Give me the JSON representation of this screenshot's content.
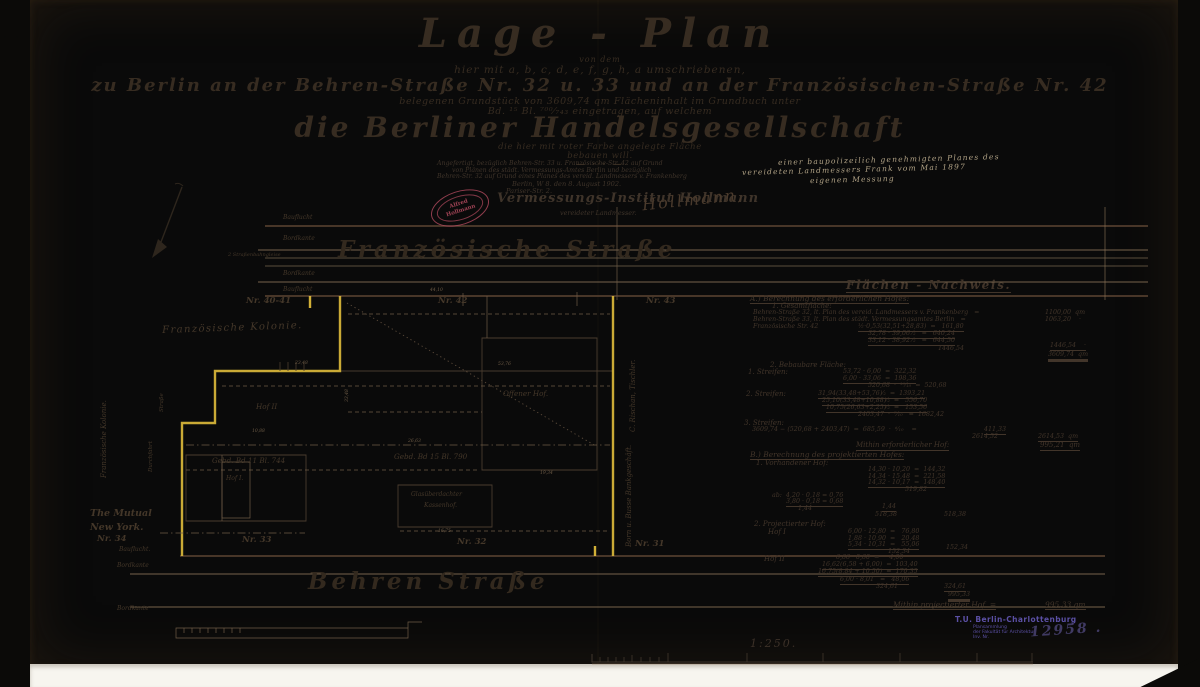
{
  "header": {
    "title": "Lage - Plan",
    "l1": "von dem",
    "l2": "hier mit a, b, c, d, e, f, g, h, a umschriebenen,",
    "l3": "zu Berlin an der Behren-Straße Nr. 32 u. 33 und an der Französischen-Straße Nr. 42",
    "l4": "belegenen Grundstück von 3609,74 qm Flächeninhalt im Grundbuch unter",
    "l5": "Bd. ¹⁵ Bl. ⁷⁰⁰⁄₇₄₃ eingetragen, auf welchem",
    "company": "die Berliner Handelsgesellschaft",
    "l6": "die hier mit roter Farbe angelegte Fläche",
    "l7": "bebauen will.",
    "divider": "— ··· —"
  },
  "attestation": {
    "a1": "Angefertigt, bezüglich Behren-Str. 33 u. Französische-Str. 42 auf Grund",
    "a2": "von Plänen des städt. Vermessungs-Amtes Berlin und bezüglich",
    "a3": "Behren-Str. 32 auf Grund eines Planes des vereid. Landmessers v. Frankenberg",
    "a4": "Berlin, W 8. den 8. August 1902.",
    "a5": "Pariser-Str. 2.",
    "institute": "Vermessungs-Institut Hollmann",
    "signature": "Hollmann,",
    "signer_title": "vereideter Landmesser.",
    "red_stamp": {
      "line1": "Alfred",
      "line2": "Hollmann"
    }
  },
  "pencil": {
    "lines": [
      {
        "t": "einer baupolizeilich genehmigten Planes des",
        "x": 778,
        "y": 156
      },
      {
        "t": "vereideten Landmessers Frank vom Mai 1897",
        "x": 742,
        "y": 166
      },
      {
        "t": "eigenen Messung",
        "x": 810,
        "y": 176
      }
    ]
  },
  "plan": {
    "labels": [
      {
        "t": "Bauflucht",
        "x": 283,
        "y": 215,
        "c": "s6"
      },
      {
        "t": "Bordkante",
        "x": 283,
        "y": 236,
        "c": "s6"
      },
      {
        "t": "2 Straßenbahngleise",
        "x": 228,
        "y": 253,
        "c": "s5"
      },
      {
        "t": "Französische Straße",
        "x": 338,
        "y": 238,
        "c": "street"
      },
      {
        "t": "Bordkante",
        "x": 283,
        "y": 271,
        "c": "s6"
      },
      {
        "t": "Bauflucht",
        "x": 283,
        "y": 287,
        "c": "s6"
      },
      {
        "t": "44,10",
        "x": 430,
        "y": 289,
        "c": "dim"
      },
      {
        "t": "Nr. 40-41",
        "x": 246,
        "y": 297,
        "c": "s8"
      },
      {
        "t": "Nr. 42",
        "x": 438,
        "y": 297,
        "c": "s8"
      },
      {
        "t": "Nr. 43",
        "x": 646,
        "y": 297,
        "c": "s8"
      },
      {
        "t": "Französische Kolonie.",
        "x": 162,
        "y": 326,
        "c": "kol"
      },
      {
        "t": "Hof II",
        "x": 256,
        "y": 403,
        "c": "s7"
      },
      {
        "t": "Offener Hof.",
        "x": 503,
        "y": 390,
        "c": "s7"
      },
      {
        "t": "Gebd. Bd 11 Bl. 744",
        "x": 212,
        "y": 457,
        "c": "s7"
      },
      {
        "t": "Gebd. Bd 15 Bl. 790",
        "x": 394,
        "y": 453,
        "c": "s7"
      },
      {
        "t": "Hof I.",
        "x": 226,
        "y": 476,
        "c": "s6"
      },
      {
        "t": "Glasüberdachter",
        "x": 411,
        "y": 492,
        "c": "s6"
      },
      {
        "t": "Kassenhof.",
        "x": 424,
        "y": 503,
        "c": "s6"
      },
      {
        "t": "The Mutual",
        "x": 90,
        "y": 509,
        "c": "s9i"
      },
      {
        "t": "New York.",
        "x": 90,
        "y": 523,
        "c": "s9i"
      },
      {
        "t": "Nr. 34",
        "x": 97,
        "y": 535,
        "c": "s8"
      },
      {
        "t": "Bauflucht.",
        "x": 119,
        "y": 547,
        "c": "s6"
      },
      {
        "t": "Nr. 33",
        "x": 242,
        "y": 536,
        "c": "s8"
      },
      {
        "t": "Nr. 32",
        "x": 457,
        "y": 538,
        "c": "s8"
      },
      {
        "t": "Nr. 31",
        "x": 635,
        "y": 540,
        "c": "s8"
      },
      {
        "t": "Bordkante",
        "x": 117,
        "y": 563,
        "c": "s6"
      },
      {
        "t": "Behren Straße",
        "x": 308,
        "y": 570,
        "c": "street"
      },
      {
        "t": "Bordkante",
        "x": 117,
        "y": 606,
        "c": "s6"
      },
      {
        "t": "Französische Kolonie.",
        "x": 101,
        "y": 478,
        "c": "vert"
      },
      {
        "t": "Straße",
        "x": 160,
        "y": 412,
        "c": "vertS"
      },
      {
        "t": "Durchfahrt",
        "x": 149,
        "y": 472,
        "c": "vertS"
      },
      {
        "t": "C. Rischan, Tischler.",
        "x": 630,
        "y": 432,
        "c": "vert"
      },
      {
        "t": "Born u. Busse Bankgeschäft.",
        "x": 626,
        "y": 547,
        "c": "vert"
      },
      {
        "t": "23,48",
        "x": 295,
        "y": 362,
        "c": "dim"
      },
      {
        "t": "53,76",
        "x": 498,
        "y": 363,
        "c": "dim"
      },
      {
        "t": "33,48",
        "x": 346,
        "y": 402,
        "c": "dimv"
      },
      {
        "t": "10,88",
        "x": 252,
        "y": 430,
        "c": "dim"
      },
      {
        "t": "26,63",
        "x": 408,
        "y": 440,
        "c": "dim"
      },
      {
        "t": "16,75",
        "x": 438,
        "y": 530,
        "c": "dim"
      },
      {
        "t": "19,34",
        "x": 540,
        "y": 472,
        "c": "dim"
      }
    ]
  },
  "calc": {
    "lines": [
      {
        "t": "Flächen - Nachweis.",
        "x": 846,
        "y": 279,
        "c": "ct",
        "u": 1
      },
      {
        "t": "A.) Berechnung des erforderlichen Hofes:",
        "x": 750,
        "y": 295,
        "s": 7.5,
        "u": 1
      },
      {
        "t": "1. Gesamtfläche:",
        "x": 772,
        "y": 303,
        "s": 7
      },
      {
        "t": "Behren-Straße 32, lt. Plan des vereid. Landmessers v. Frankenberg   =",
        "x": 753,
        "y": 310
      },
      {
        "t": "1100,00  qm",
        "x": 1045,
        "y": 310
      },
      {
        "t": "Behren-Straße 33, lt. Plan des städt. Vermessungsamtes Berlin   =",
        "x": 753,
        "y": 317
      },
      {
        "t": "1063,20    ·",
        "x": 1045,
        "y": 317
      },
      {
        "t": "Französische Str. 42",
        "x": 753,
        "y": 324
      },
      {
        "t": "½·0,53(32,51+28,83)  =   161,80",
        "x": 858,
        "y": 324,
        "u": 1
      },
      {
        "t": "32,78 · 39,06 ⁄₂   =   640,24",
        "x": 868,
        "y": 331,
        "u": 1
      },
      {
        "t": "33,12 · 38,92 ⁄₂   =   644,50",
        "x": 868,
        "y": 338,
        "u": 1
      },
      {
        "t": "1446,54",
        "x": 938,
        "y": 346
      },
      {
        "t": "1446,54    ·",
        "x": 1050,
        "y": 343,
        "u": 1
      },
      {
        "t": "3609,74  qm",
        "x": 1048,
        "y": 352,
        "u": 2
      },
      {
        "t": "2. Bebaubare Fläche:",
        "x": 770,
        "y": 362,
        "s": 7
      },
      {
        "t": "1. Streifen:",
        "x": 748,
        "y": 369,
        "s": 7
      },
      {
        "t": "53,72 · 6,00  =  322,32",
        "x": 843,
        "y": 369
      },
      {
        "t": "6,00 · 33,06  =  198,36",
        "x": 843,
        "y": 376,
        "u": 1
      },
      {
        "t": "520,68  ·  ¹⁰⁄₁₀  =  520,68",
        "x": 868,
        "y": 383
      },
      {
        "t": "2. Streifen:",
        "x": 746,
        "y": 391,
        "s": 7
      },
      {
        "t": "31,94(33,48+53,76)⁄₂  =  1393,21",
        "x": 818,
        "y": 391,
        "u": 1
      },
      {
        "t": "25,10(33,48+10,88)⁄₂  =   556,70",
        "x": 822,
        "y": 398,
        "u": 1
      },
      {
        "t": "10,75(26,63+2,25)⁄₂  =   153,56",
        "x": 826,
        "y": 405,
        "u": 1
      },
      {
        "t": "2403,47  ·  ⁷⁄₁₀   =  1682,42",
        "x": 858,
        "y": 412
      },
      {
        "t": "3. Streifen:",
        "x": 744,
        "y": 420,
        "s": 7
      },
      {
        "t": "3609,74 − (520,68 + 2403,47)  =  685,59  ·  ⁶⁄₁₀    =",
        "x": 752,
        "y": 427
      },
      {
        "t": "411,33",
        "x": 984,
        "y": 427,
        "u": 1
      },
      {
        "t": "2614,52",
        "x": 972,
        "y": 434
      },
      {
        "t": "2614,53  qm",
        "x": 1038,
        "y": 434,
        "u": 1
      },
      {
        "t": "Mithin erforderlicher Hof:",
        "x": 856,
        "y": 442,
        "s": 7,
        "u": 1
      },
      {
        "t": "995,21  qm",
        "x": 1040,
        "y": 442,
        "s": 7,
        "u": 1
      },
      {
        "t": "B.) Berechnung des projektierten Hofes:",
        "x": 750,
        "y": 451,
        "s": 7.5,
        "u": 1
      },
      {
        "t": "1. Vorhandener Hof:",
        "x": 756,
        "y": 460,
        "s": 7
      },
      {
        "t": "14,30 · 10,20  =  144,32",
        "x": 868,
        "y": 467
      },
      {
        "t": "14,34 · 15,48  =  221,58",
        "x": 868,
        "y": 474
      },
      {
        "t": "14,32 · 10,17  =  148,40",
        "x": 868,
        "y": 480,
        "u": 1
      },
      {
        "t": "519,82",
        "x": 905,
        "y": 487
      },
      {
        "t": "ab:  4,20 · 0,18 = 0,76",
        "x": 772,
        "y": 493
      },
      {
        "t": "3,80 · 0,18 = 0,68",
        "x": 786,
        "y": 499,
        "u": 1
      },
      {
        "t": "1,44",
        "x": 798,
        "y": 506
      },
      {
        "t": "1,44",
        "x": 882,
        "y": 504,
        "u": 1
      },
      {
        "t": "518,38",
        "x": 875,
        "y": 512
      },
      {
        "t": "518,38",
        "x": 944,
        "y": 512
      },
      {
        "t": "2. Projectierter Hof:",
        "x": 754,
        "y": 521,
        "s": 7
      },
      {
        "t": "Hof I",
        "x": 768,
        "y": 529,
        "s": 7
      },
      {
        "t": "6,00 · 12,80  =   76,80",
        "x": 848,
        "y": 529
      },
      {
        "t": "1,88 · 10,90  =   20,48",
        "x": 848,
        "y": 536
      },
      {
        "t": "5,34 · 10,31  =   55,06",
        "x": 848,
        "y": 542,
        "u": 1
      },
      {
        "t": "152,34",
        "x": 888,
        "y": 549
      },
      {
        "t": "152,34",
        "x": 946,
        "y": 545
      },
      {
        "t": "Hof II",
        "x": 764,
        "y": 556,
        "s": 7
      },
      {
        "t": "6,66 · 0,60  =     4,00",
        "x": 836,
        "y": 555
      },
      {
        "t": "16,62(6,58 + 6,00)  =  103,40",
        "x": 822,
        "y": 562,
        "u": 1
      },
      {
        "t": "16,75(8,84 + 10,50)  =  170,35",
        "x": 818,
        "y": 569,
        "u": 1
      },
      {
        "t": "6,00 · 8,01   =   48,06",
        "x": 840,
        "y": 577,
        "u": 1
      },
      {
        "t": "324,61",
        "x": 876,
        "y": 584
      },
      {
        "t": "324,61",
        "x": 944,
        "y": 584,
        "u": 1
      },
      {
        "t": "995,33",
        "x": 948,
        "y": 592,
        "u": 2
      },
      {
        "t": "Mithin projectierter Hof  =",
        "x": 893,
        "y": 601,
        "s": 7.5,
        "u": 1
      },
      {
        "t": "995,33 qm",
        "x": 1045,
        "y": 601,
        "s": 7.5,
        "u": 1
      }
    ]
  },
  "scale": {
    "label": "1:250."
  },
  "tu_stamp": {
    "line1": "T.U. Berlin-Charlottenburg",
    "line2": "Plansammlung",
    "line3": "der Fakultät für Architektur",
    "line4": "Inv. Nr.",
    "number": "12958 ."
  },
  "colors": {
    "paper": "#e9dcc2",
    "ink": "#42352a",
    "boundary_yellow": "#e7c33c",
    "stamp_red": "#b24a5e",
    "stamp_purple": "#5b50a5",
    "pencil": "#b3a487"
  }
}
